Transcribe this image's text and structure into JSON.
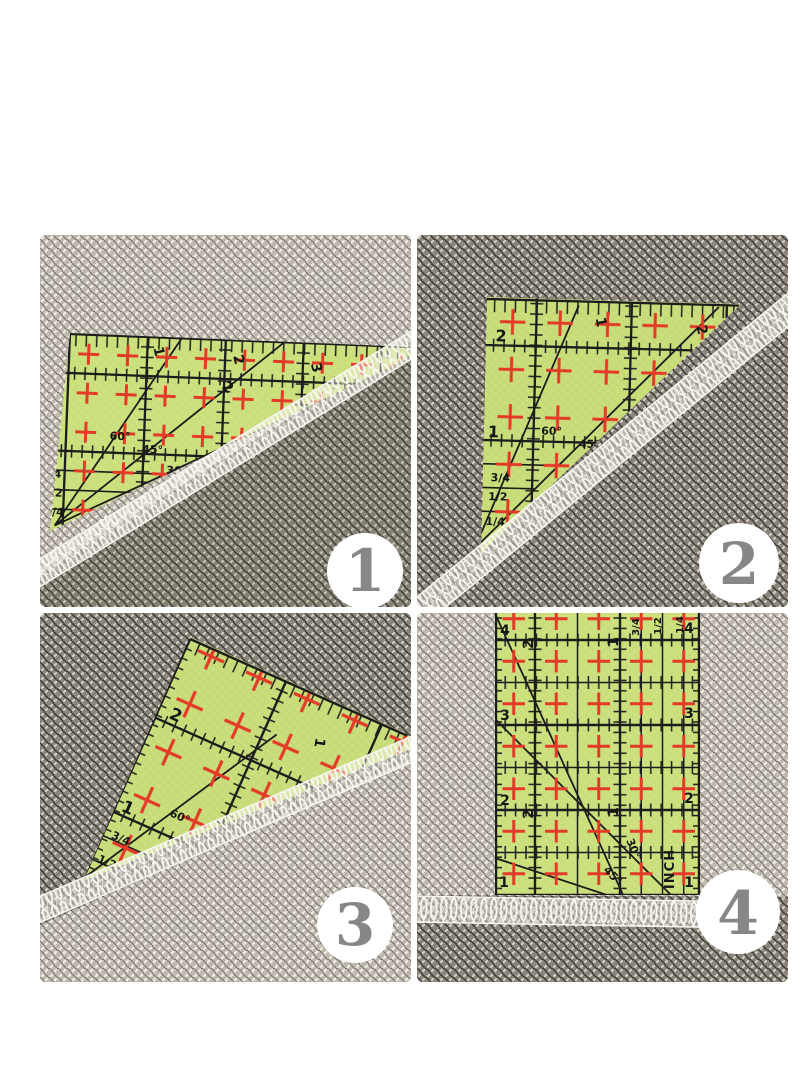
{
  "collage": {
    "layout": "2x2-photo-grid",
    "subject": "green quilting ruler on gray woven fabric with white serged edge"
  },
  "colors": {
    "background": "#ffffff",
    "ruler_green": "#cbe27a",
    "grid_line": "#1c1c1c",
    "cross_red": "#e33b28",
    "fabric_light": "#beb8ae",
    "fabric_dark": "#8b867c",
    "serge_white": "#faf8f2",
    "badge_background": "#ffffff",
    "badge_number_gray": "#878787",
    "inch_label_red": "#d42b20"
  },
  "panels": [
    {
      "badge": "1",
      "ruler": {
        "left_scale": [
          "2",
          "1",
          "3/4",
          "1/2",
          "1/4"
        ],
        "top_scale": [
          "1",
          "2",
          "3"
        ],
        "diagonal_scale": [
          "2"
        ],
        "angle_labels": [
          "60°",
          "45°",
          "30°"
        ]
      }
    },
    {
      "badge": "2",
      "ruler": {
        "left_scale": [
          "2",
          "1",
          "3/4",
          "1/2",
          "1/4"
        ],
        "top_scale": [
          "1",
          "2"
        ],
        "edge_scale": [
          "2"
        ],
        "angle_labels": [
          "60°",
          "45°"
        ]
      }
    },
    {
      "badge": "3",
      "ruler": {
        "left_scale": [
          "2",
          "1",
          "3/4",
          "1/2"
        ],
        "top_scale": [
          "1"
        ],
        "angle_labels": [
          "60°"
        ]
      }
    },
    {
      "badge": "4",
      "ruler": {
        "left_scale": [
          "4",
          "3",
          "2",
          "1"
        ],
        "right_scale": [
          "4",
          "3",
          "2",
          "1"
        ],
        "top_inner_scale": [
          "2",
          "1"
        ],
        "bottom_inner_scale": [
          "2",
          "1"
        ],
        "fraction_scale": [
          "3/4",
          "1/2",
          "1/4"
        ],
        "angle_labels": [
          "45°",
          "30°"
        ],
        "unit_label": "INCH"
      }
    }
  ]
}
